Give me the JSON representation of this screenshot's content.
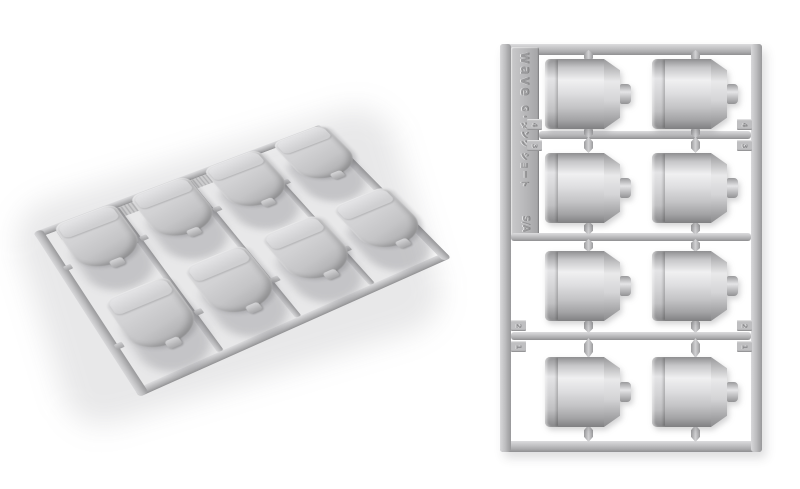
{
  "scene": {
    "description": "Two product photos of a light-gray plastic model sprue (runner) holding eight cylindrical propellant-tank parts: angled view on the left, top-down view on the right",
    "background_color": "#ffffff",
    "plastic_color": "#c7c7c9",
    "plastic_highlight": "#efeff1",
    "plastic_shadow": "#8a8a8c"
  },
  "sprue": {
    "brand": "wave",
    "label": "G・タンク ショート",
    "mold_mark": "S/A",
    "part_count": "8",
    "tabs": {
      "rail_a": {
        "top": "4",
        "bottom": "3"
      },
      "rail_b": {
        "top": "2",
        "bottom": "1"
      }
    }
  }
}
